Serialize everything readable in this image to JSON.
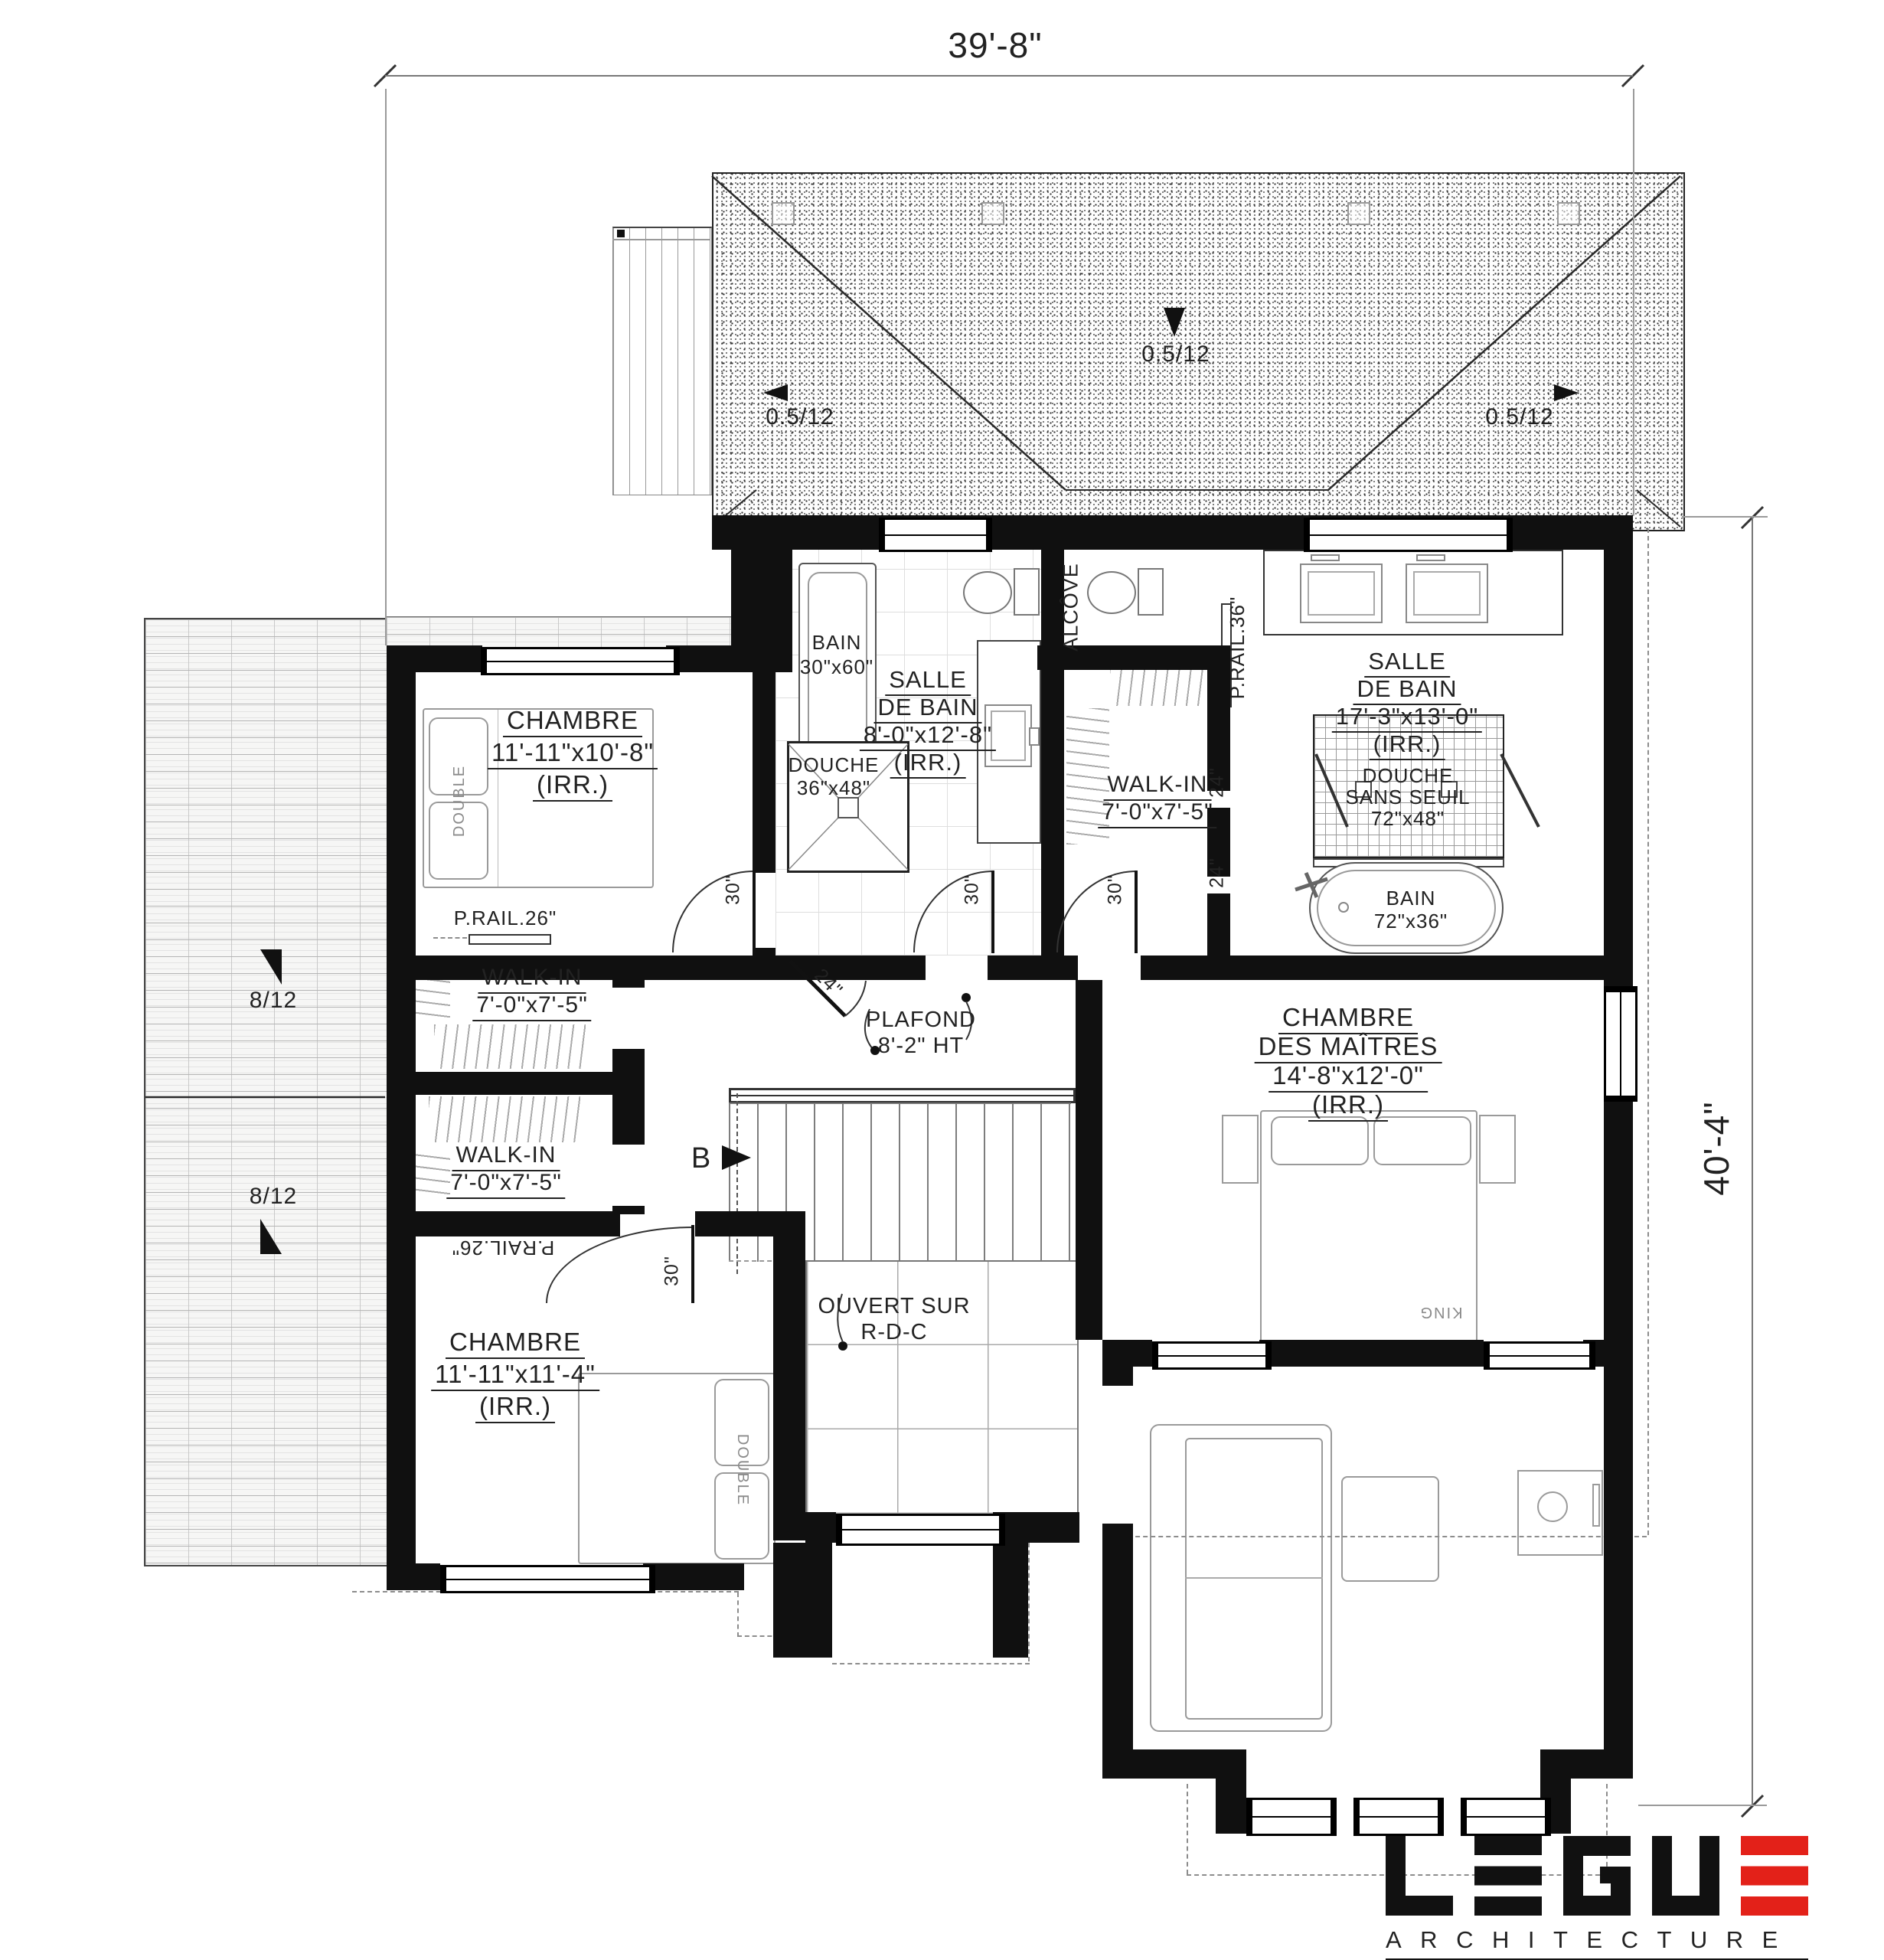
{
  "dimensions": {
    "width": "39'-8\"",
    "height": "40'-4\""
  },
  "slopes": {
    "low": "0.5/12",
    "steep": "8/12"
  },
  "labels": {
    "bedroom_upper": {
      "name": "CHAMBRE",
      "size": "11'-11\"x10'-8\"",
      "irr": "(IRR.)"
    },
    "bath_main": {
      "l1": "SALLE",
      "l2": "DE BAIN",
      "size": "8'-0\"x12'-8\"",
      "irr": "(IRR.)"
    },
    "tub_main": {
      "l1": "BAIN",
      "l2": "30\"x60\""
    },
    "shower_main": {
      "l1": "DOUCHE",
      "l2": "36\"x48\""
    },
    "alcove": "ALCÔVE",
    "prail36": "P.RAIL.36\"",
    "walkin": {
      "l1": "WALK-IN",
      "size": "7'-0\"x7'-5\""
    },
    "bath_master": {
      "l1": "SALLE",
      "l2": "DE BAIN",
      "size": "17'-3\"x13'-0\"",
      "irr": "(IRR.)"
    },
    "shower_master": {
      "l1": "DOUCHE",
      "l2": "SANS SEUIL",
      "size": "72\"x48\""
    },
    "tub_master": {
      "l1": "BAIN",
      "size": "72\"x36\""
    },
    "bedroom_master": {
      "l1": "CHAMBRE",
      "l2": "DES MAÎTRES",
      "size": "14'-8\"x12'-0\"",
      "irr": "(IRR.)"
    },
    "ceiling": {
      "l1": "PLAFOND",
      "l2": "8'-2\" HT"
    },
    "prail26": "P.RAIL.26\"",
    "open_below": {
      "l1": "OUVERT SUR",
      "l2": "R-D-C"
    },
    "bedroom_lower": {
      "name": "CHAMBRE",
      "size": "11'-11\"x11'-4\"",
      "irr": "(IRR.)"
    },
    "door30": "30\"",
    "door24": "24\"",
    "dim24": "24\"",
    "section": "B",
    "bed_double": "DOUBLE",
    "bed_king": "KING"
  },
  "logo": {
    "name": "LEGU",
    "sub": "ARCHITECTURE",
    "accent": "#e32119"
  }
}
